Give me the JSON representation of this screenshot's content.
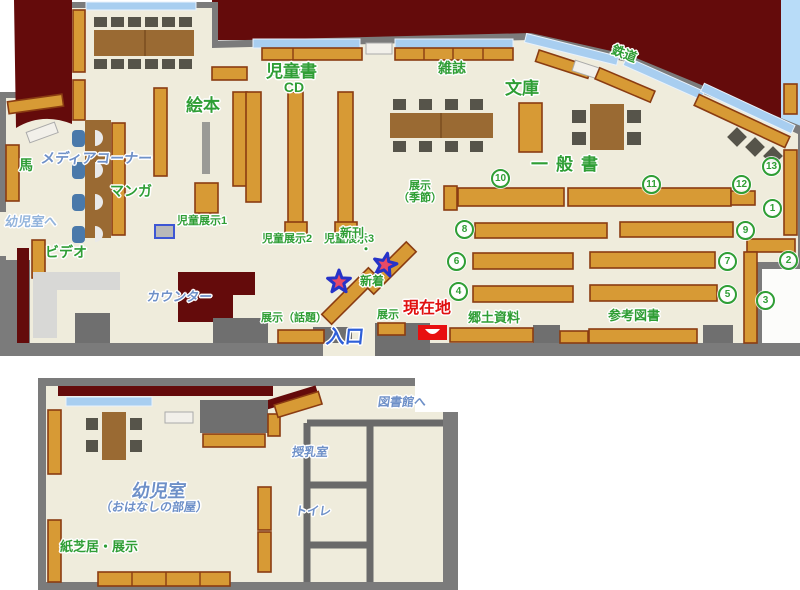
{
  "map_title": "library-floor-map",
  "colors": {
    "floor": "#efecdc",
    "wall": "#7b7b7b",
    "closed_area": "#640b0b",
    "shelf": "#d79a35",
    "shelf_border": "#8a3c12",
    "window": "#a8cef0",
    "sky": "#b8dcf8",
    "marker_red": "#e81010",
    "text_green": "#2f9e35",
    "text_blue": "#6e90c8",
    "text_lightblue": "#93b4dc",
    "text_entrance_blue": "#2e5fd8",
    "text_red": "#e01010",
    "star_fill": "#e84a66",
    "star_border": "#2633c8"
  },
  "labels": [
    {
      "id": "dvd-cd",
      "text": "DVD・\nCD",
      "cls": "green",
      "x": 266,
      "y": 64,
      "fs": 14,
      "w": 56,
      "ta": "center"
    },
    {
      "id": "ehon",
      "text": "絵本",
      "cls": "green",
      "x": 186,
      "y": 96,
      "fs": 17
    },
    {
      "id": "jidosho",
      "text": "児童書",
      "cls": "green",
      "x": 266,
      "y": 62,
      "fs": 17
    },
    {
      "id": "zasshi",
      "text": "雑誌",
      "cls": "green",
      "x": 438,
      "y": 61,
      "fs": 14
    },
    {
      "id": "bunko",
      "text": "文庫",
      "cls": "green",
      "x": 505,
      "y": 79,
      "fs": 17
    },
    {
      "id": "tetsudo",
      "text": "鉄道",
      "cls": "green",
      "x": 611,
      "y": 47,
      "fs": 13,
      "rot": 21
    },
    {
      "id": "ippansho",
      "text": "一般書",
      "cls": "green",
      "x": 531,
      "y": 155,
      "fs": 17,
      "ls": 8
    },
    {
      "id": "uma",
      "text": "馬",
      "cls": "green",
      "x": 19,
      "y": 158,
      "fs": 14
    },
    {
      "id": "media-corner",
      "text": "メディアコーナー",
      "cls": "blue",
      "x": 41,
      "y": 151,
      "fs": 14
    },
    {
      "id": "manga",
      "text": "マンガ",
      "cls": "green",
      "x": 110,
      "y": 184,
      "fs": 14
    },
    {
      "id": "yojishitsu-e",
      "text": "幼児室へ",
      "cls": "lightblue",
      "x": 5,
      "y": 215,
      "fs": 13
    },
    {
      "id": "video",
      "text": "ビデオ",
      "cls": "green",
      "x": 45,
      "y": 245,
      "fs": 14
    },
    {
      "id": "counter",
      "text": "カウンター",
      "cls": "blue",
      "x": 147,
      "y": 290,
      "fs": 13
    },
    {
      "id": "jido-tenji-1",
      "text": "児童展示1",
      "cls": "green",
      "x": 177,
      "y": 215,
      "fs": 11
    },
    {
      "id": "jido-tenji-2",
      "text": "児童展示2",
      "cls": "green",
      "x": 262,
      "y": 233,
      "fs": 11
    },
    {
      "id": "jido-tenji-3",
      "text": "児童展示3",
      "cls": "green",
      "x": 324,
      "y": 233,
      "fs": 11
    },
    {
      "id": "shinkan",
      "text": "新刊",
      "cls": "green",
      "x": 340,
      "y": 227,
      "fs": 12
    },
    {
      "id": "shinkan-dot",
      "text": "・",
      "cls": "green",
      "x": 360,
      "y": 243,
      "fs": 12
    },
    {
      "id": "shinchaku",
      "text": "新着",
      "cls": "green",
      "x": 360,
      "y": 275,
      "fs": 12
    },
    {
      "id": "tenji-wadai",
      "text": "展示（話題）",
      "cls": "green",
      "x": 261,
      "y": 312,
      "fs": 11
    },
    {
      "id": "tenji-kisetsu",
      "text": "展示\n（季節）",
      "cls": "green",
      "x": 394,
      "y": 180,
      "fs": 11,
      "w": 52,
      "ta": "center"
    },
    {
      "id": "tenji-mini",
      "text": "展示",
      "cls": "green",
      "x": 377,
      "y": 309,
      "fs": 11
    },
    {
      "id": "genzaichi",
      "text": "現在地",
      "cls": "red",
      "x": 403,
      "y": 300,
      "fs": 16
    },
    {
      "id": "kyodo-shiryo",
      "text": "郷土資料",
      "cls": "green",
      "x": 468,
      "y": 311,
      "fs": 13
    },
    {
      "id": "sanko-tosho",
      "text": "参考図書",
      "cls": "green",
      "x": 608,
      "y": 309,
      "fs": 13
    },
    {
      "id": "iriguchi",
      "text": "入口",
      "cls": "entrance",
      "x": 326,
      "y": 327,
      "fs": 19
    },
    {
      "id": "yojishitsu",
      "text": "幼児室",
      "cls": "blue",
      "x": 121,
      "y": 481,
      "fs": 18,
      "w": 76,
      "ta": "center"
    },
    {
      "id": "ohanashi",
      "text": "（おはなしの部屋）",
      "cls": "blue",
      "x": 100,
      "y": 501,
      "fs": 12
    },
    {
      "id": "kamishibai",
      "text": "紙芝居・展示",
      "cls": "green",
      "x": 60,
      "y": 540,
      "fs": 13
    },
    {
      "id": "junyushitsu",
      "text": "授乳室",
      "cls": "blue",
      "x": 292,
      "y": 446,
      "fs": 12
    },
    {
      "id": "toire",
      "text": "トイレ",
      "cls": "blue",
      "x": 295,
      "y": 505,
      "fs": 12
    },
    {
      "id": "toshokan-e",
      "text": "図書館へ",
      "cls": "blue",
      "x": 378,
      "y": 396,
      "fs": 12
    }
  ],
  "circled_numbers": [
    {
      "n": "1",
      "x": 772,
      "y": 208
    },
    {
      "n": "2",
      "x": 788,
      "y": 260
    },
    {
      "n": "3",
      "x": 765,
      "y": 300
    },
    {
      "n": "4",
      "x": 458,
      "y": 291
    },
    {
      "n": "5",
      "x": 727,
      "y": 294
    },
    {
      "n": "6",
      "x": 456,
      "y": 261
    },
    {
      "n": "7",
      "x": 727,
      "y": 261
    },
    {
      "n": "8",
      "x": 464,
      "y": 229
    },
    {
      "n": "9",
      "x": 745,
      "y": 230
    },
    {
      "n": "10",
      "x": 500,
      "y": 178
    },
    {
      "n": "11",
      "x": 651,
      "y": 184
    },
    {
      "n": "12",
      "x": 741,
      "y": 184
    },
    {
      "n": "13",
      "x": 771,
      "y": 166
    }
  ]
}
